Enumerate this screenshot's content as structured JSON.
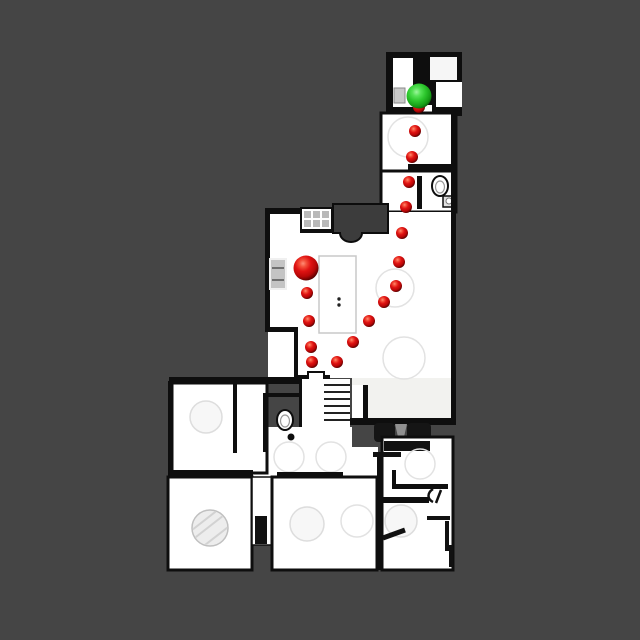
{
  "scene": {
    "background_color": "#454545",
    "floor_color": "#ffffff",
    "wall_color": "#0e0e0e",
    "canvas_width": 640,
    "canvas_height": 640,
    "description": "top-down floor plan with navigation path"
  },
  "markers": {
    "goal": {
      "x": 419,
      "y": 96,
      "radius": 12.5,
      "color": "#2ec82e"
    },
    "start": {
      "x": 306,
      "y": 268,
      "radius": 12.5,
      "color": "#d41414"
    },
    "waypoints": {
      "radius": 6,
      "color": "#d41414",
      "points": [
        {
          "x": 307,
          "y": 293
        },
        {
          "x": 309,
          "y": 321
        },
        {
          "x": 311,
          "y": 347
        },
        {
          "x": 312,
          "y": 362
        },
        {
          "x": 337,
          "y": 362
        },
        {
          "x": 353,
          "y": 342
        },
        {
          "x": 369,
          "y": 321
        },
        {
          "x": 384,
          "y": 302
        },
        {
          "x": 396,
          "y": 286
        },
        {
          "x": 399,
          "y": 262
        },
        {
          "x": 402,
          "y": 233
        },
        {
          "x": 406,
          "y": 207
        },
        {
          "x": 409,
          "y": 182
        },
        {
          "x": 412,
          "y": 157
        },
        {
          "x": 415,
          "y": 131
        },
        {
          "x": 419,
          "y": 107
        }
      ]
    }
  }
}
